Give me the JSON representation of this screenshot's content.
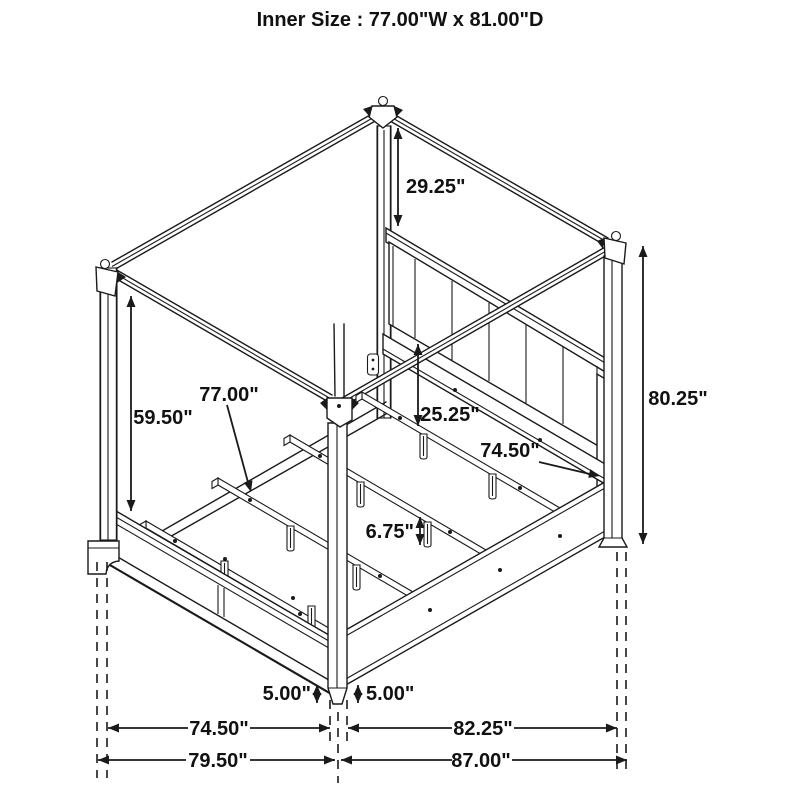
{
  "header": {
    "title": "Inner Size : 77.00\"W x 81.00\"D"
  },
  "diagram": {
    "subject": "four-poster canopy bed frame, isometric line drawing",
    "inner_width": "77.00\"",
    "inner_depth": "81.00\"",
    "line_color": "#1a1a1a",
    "background": "#ffffff"
  },
  "dimensions": [
    {
      "id": "canopy-to-headboard-drop",
      "value": "29.25\""
    },
    {
      "id": "footboard-to-canopy-height",
      "value": "59.50\""
    },
    {
      "id": "slat-width",
      "value": "77.00\""
    },
    {
      "id": "headboard-rail-height",
      "value": "25.25\""
    },
    {
      "id": "inner-rail-length",
      "value": "74.50\""
    },
    {
      "id": "overall-post-height",
      "value": "80.25\""
    },
    {
      "id": "slat-leg-height",
      "value": "6.75\""
    },
    {
      "id": "footboard-clearance",
      "value": "5.00\""
    },
    {
      "id": "side-rail-clearance",
      "value": "5.00\""
    },
    {
      "id": "footboard-inner-width",
      "value": "74.50\""
    },
    {
      "id": "overall-width",
      "value": "79.50\""
    },
    {
      "id": "side-inner-depth",
      "value": "82.25\""
    },
    {
      "id": "overall-depth",
      "value": "87.00\""
    }
  ]
}
